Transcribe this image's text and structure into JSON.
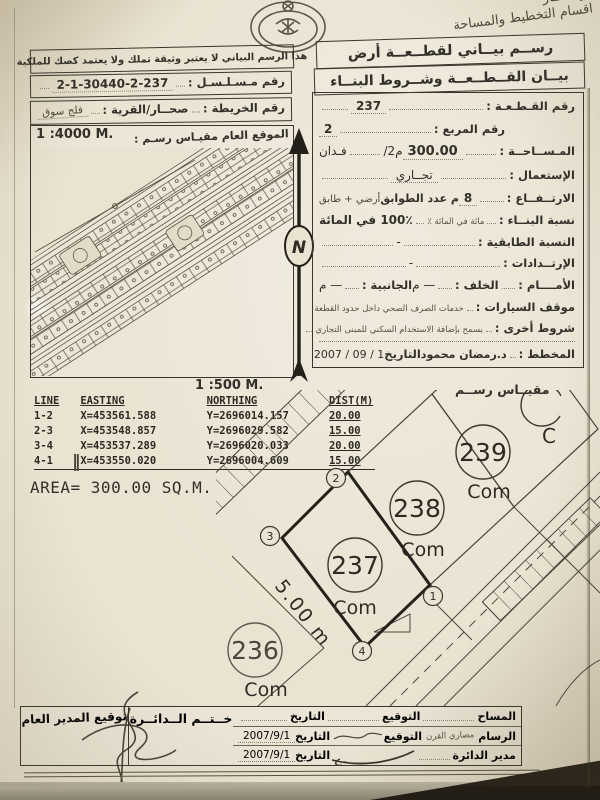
{
  "header": {
    "note_line1": "ـر صحـار",
    "note_line2": "اقسام التخطيط والمساحة"
  },
  "top": {
    "disclaimer": "هذا الرسم البياني لا يعتبر وثيقة تملك ولا يعتمد كصك للملكية",
    "serial_label": "رقم مـسـلـسـل :",
    "serial_value": "2-1-30440-2-237",
    "map_label": "رقم الخريطة :",
    "map_value": "صحــار/القرية :",
    "village_value": "فلج سوق"
  },
  "overview": {
    "scale": "1 :4000 M.",
    "title": "الموقع العام مقيـاس رسـم :"
  },
  "form": {
    "title1": "رســم بيــاني لقطــعــة أرض",
    "title2": "بيــان القــطــعــة وشــروط البنــاء",
    "plot_no_label": "رقم القـطـعـة :",
    "plot_no": "237",
    "square_label": "رقم المربع :",
    "square_no": "2",
    "area_label": "المـســاحــة :",
    "area_value": "300.00",
    "area_unit": "/م2",
    "area_unit2": "فـدان",
    "use_label": "الإستعمال :",
    "use_value": "تجــاري",
    "height_label": "الارتــفــاع :",
    "height_value": "8",
    "height_mid": "م عدد الطوابق",
    "height_note": "أرضي + طابق",
    "ratio_label": "نسبة البنــاء :",
    "ratio_note": "مائة في المائة ٪",
    "ratio_value": "100٪ في المائة",
    "floor_label": "النسبة الطابقية :",
    "floor_value": "-",
    "setback_label": "الإرتــدادات :",
    "setback_value": "-",
    "front_label": "الأمــــام :",
    "back_label": "الخلف :",
    "back_value": "— م",
    "side_label": "الجانبية :",
    "side_value": "— م",
    "parking_label": "موقف السيارات :",
    "parking_value": "خدمات الصرف الصحي داخل حدود القطعة",
    "other_label": "شروط أخرى :",
    "other_value": "يسمح بإضافة الاستخدام السكني للمبنى التجاري",
    "planner_label": "المخطط :",
    "planner_value": "د.رمضان محمود",
    "date_label": "التاريخ",
    "date_value": "2007 / 09 / 1"
  },
  "scale500": {
    "label_ar": "مقيــاس رســم",
    "value": "1 :500 M."
  },
  "coords": {
    "headers": {
      "line": "LINE",
      "easting": "EASTING",
      "northing": "NORTHING",
      "dist": "DIST(M)"
    },
    "rows": [
      {
        "line": "1-2",
        "easting": "X=453561.588",
        "northing": "Y=2696014.157",
        "dist": "20.00"
      },
      {
        "line": "2-3",
        "easting": "X=453548.857",
        "northing": "Y=2696029.582",
        "dist": "15.00"
      },
      {
        "line": "3-4",
        "easting": "X=453537.289",
        "northing": "Y=2696020.033",
        "dist": "20.00"
      },
      {
        "line": "4-1",
        "easting": "X=453550.020",
        "northing": "Y=2696004.609",
        "dist": "15.00"
      }
    ],
    "tick": "‖",
    "area": "AREA= 300.00 SQ.M."
  },
  "north": {
    "letter": "N"
  },
  "diagram": {
    "plot236": "236",
    "plot237": "237",
    "plot238": "238",
    "plot239": "239",
    "com": "Com",
    "c1": "1",
    "c2": "2",
    "c3": "3",
    "c4": "4",
    "dim": "5.00 m",
    "partial": "C"
  },
  "signatures": {
    "row1_role": "المساح",
    "row1_sign": "التوقيع",
    "row1_date_label": "التاريخ",
    "row2_role": "الرسام",
    "row2_note": "مصاري القرن",
    "row2_sign": "التوقيع",
    "row2_date_label": "التاريخ",
    "row2_date": "2007/9/1",
    "row3_role": "مدير الدائرة",
    "row3_date_label": "التاريخ",
    "row3_date": "2007/9/1",
    "stamp_cell": "خــتــم الــدائــرة",
    "gm_cell": "توقيع المدير العام"
  }
}
